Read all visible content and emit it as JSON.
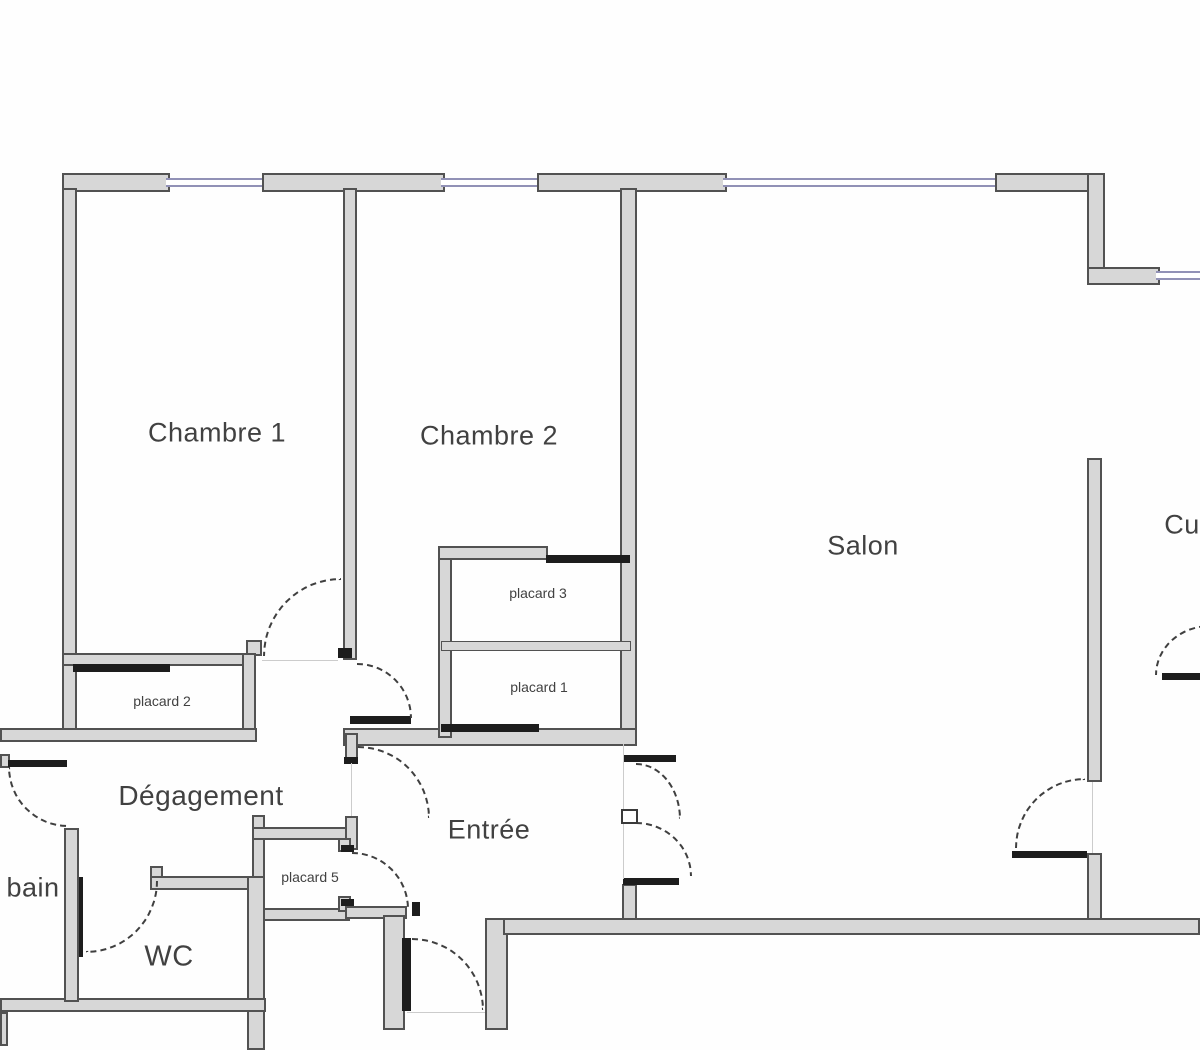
{
  "plan_title": "apartment-floor-plan",
  "rooms": {
    "chambre1": {
      "label": "Chambre 1"
    },
    "chambre2": {
      "label": "Chambre 2"
    },
    "salon": {
      "label": "Salon"
    },
    "cuisine": {
      "label": "Cu"
    },
    "degagement": {
      "label": "Dégagement"
    },
    "entree": {
      "label": "Entrée"
    },
    "bain": {
      "label": "bain"
    },
    "wc": {
      "label": "WC"
    }
  },
  "closets": {
    "placard1": {
      "label": "placard 1"
    },
    "placard2": {
      "label": "placard 2"
    },
    "placard3": {
      "label": "placard 3"
    },
    "placard5": {
      "label": "placard 5"
    }
  },
  "palette": {
    "wall_fill": "#d7d7d7",
    "wall_edge": "#525252",
    "window_line": "#9191b6",
    "door_leaf": "#1d1d1d",
    "swing_arc": "#3f3f3f",
    "label_text": "#414141",
    "background": "#ffffff"
  }
}
